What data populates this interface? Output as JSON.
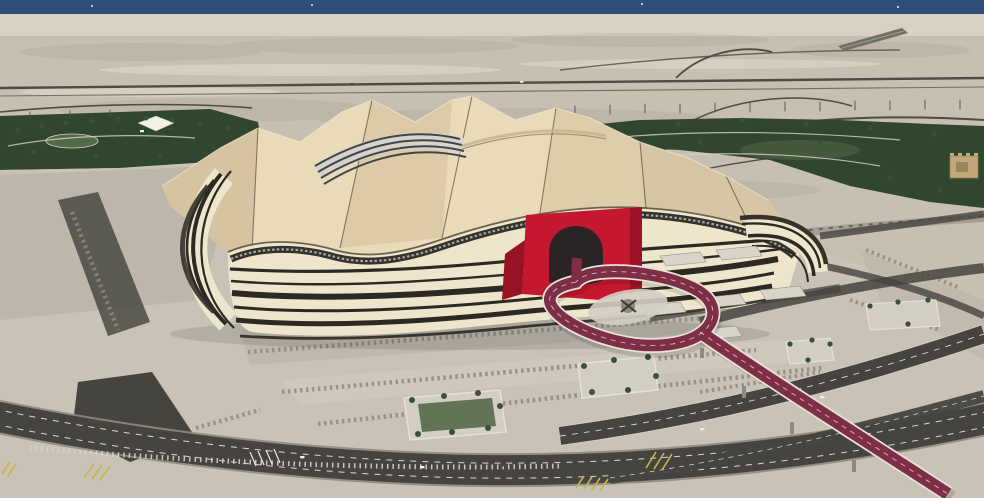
{
  "scene": {
    "type": "aerial-photograph",
    "subject": "Tent-shaped desert stadium with black-and-white striped facade, red arched entrance portal and a teardrop looping elevated maroon roadway",
    "setting": "coastal desert plain with highways, landscaped green parks, concrete plazas, terraced steps and tree planters",
    "landmarks": [
      "sea horizon strip",
      "desert highways and runway strip",
      "tent-form fabric roof with dark ridge seams",
      "striped retractable-roof tracks",
      "striped bayt-al-shaar facade",
      "red entrance arch",
      "teardrop loop bridge",
      "tree planters on plaza",
      "multi-lane ring roads with yellow hatching"
    ]
  },
  "colors": {
    "sea": "#30507a",
    "desert": "#c7bfb1",
    "haze": "#dad4c7",
    "mottle": "#8e8878",
    "streak": "#e6e0d2",
    "park": "#31462f",
    "park_light": "#55694a",
    "roof_light": "#e9dab8",
    "roof_mid": "#d9c7a2",
    "roof_shade": "#c6b28d",
    "roof_edge": "#f3ead2",
    "ridge": "#4a4537",
    "track_base": "#d6d3cb",
    "track_rail": "#41454b",
    "facade_cream": "#ede5cc",
    "facade_dark": "#2b2922",
    "window_band": "#34322b",
    "window_glint": "#ccd1d3",
    "arch_red": "#c5182f",
    "arch_red_dark": "#971223",
    "arch_opening": "#2b2427",
    "loop_road": "#7e2e47",
    "casing": "#e8e3d9",
    "plaza": "#c8c2b7",
    "plaza_mid": "#b4aea3",
    "plaza_light": "#d3cec3",
    "plaza_shade": "#8f897f",
    "asphalt": "#454440",
    "asphalt_dark": "#3a3934",
    "lane": "#ece9e1",
    "yellow": "#c9b54a",
    "tree": "#3a5136",
    "pole": "#4e4c45",
    "concrete": "#d9d4c9",
    "runway": "#716f66",
    "runway_line": "#a9a69c",
    "fort": "#c2a878",
    "fort_dark": "#8f7c54",
    "shadow": "#000000",
    "car_light": "#ededea",
    "car_dark": "#474743",
    "white": "#f2f0ea",
    "island": "#8e8880"
  }
}
